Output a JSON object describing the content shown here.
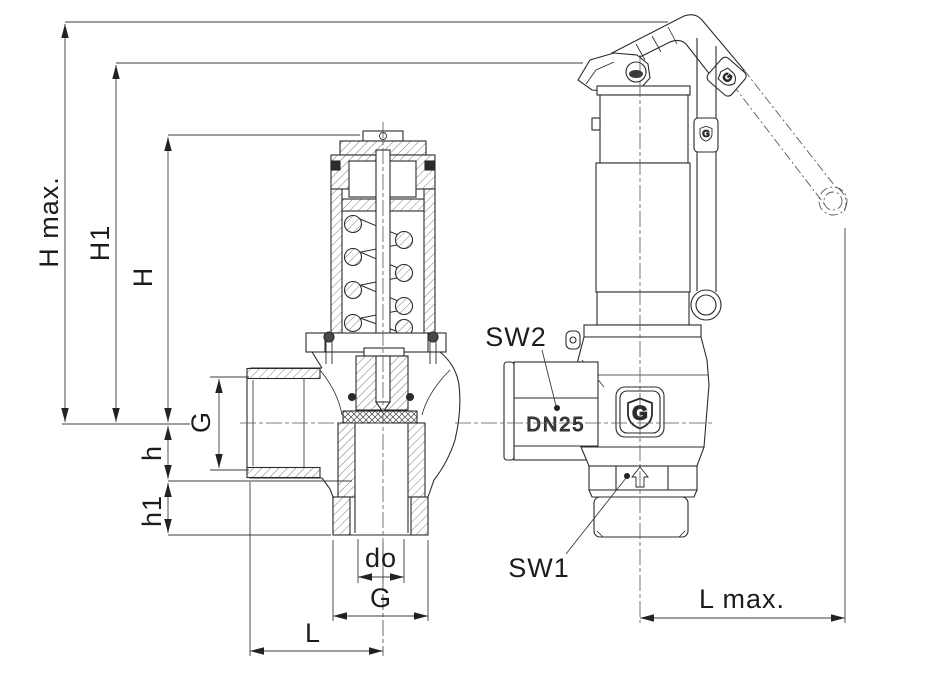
{
  "drawing": {
    "type": "technical-drawing",
    "subject": "spring-loaded safety relief valve, sectional view and side view with lifting lever",
    "labels": {
      "h_max": "H max.",
      "h1": "H1",
      "h": "H",
      "g_inlet": "G",
      "h_small": "h",
      "h1_small": "h1",
      "d_o": "do",
      "g_outlet": "G",
      "l": "L",
      "l_max": "L max.",
      "sw2": "SW2",
      "sw1": "SW1",
      "dn25": "DN25",
      "logo_letter": "G"
    },
    "colors": {
      "outline": "#2b2b2b",
      "dimension": "#3c3c3c",
      "background": "#ffffff"
    }
  }
}
